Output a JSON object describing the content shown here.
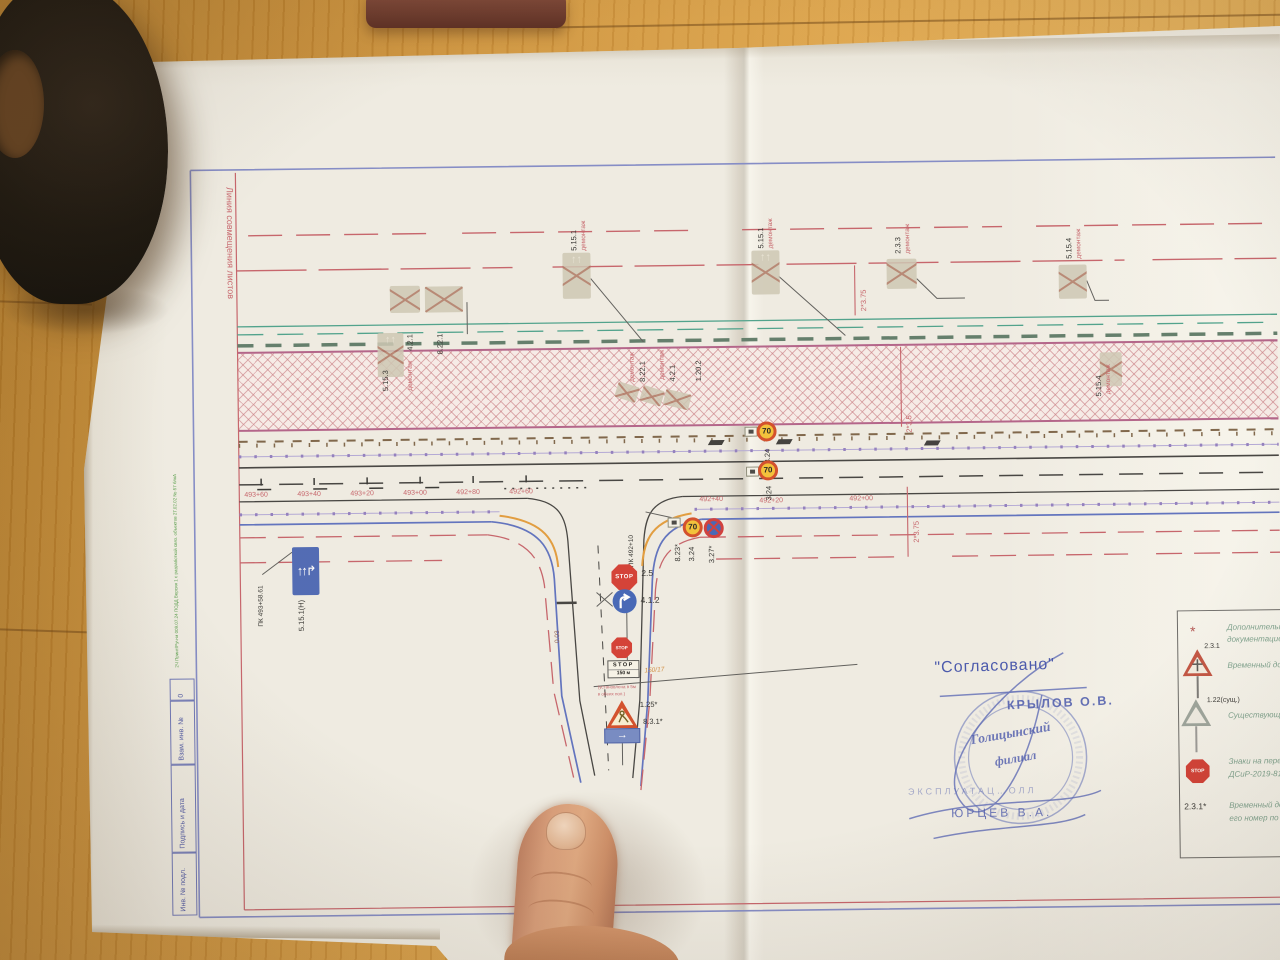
{
  "plan": {
    "edge_note": "Линия совмещения листов",
    "side_note": "2Ч Принт/Руч-м 009.07.24 ПОДД Версия 1 с разработкой связ. объектов 2Т.02.02 №-57 блкА",
    "titleblock": {
      "row_top": "Взам. инв. №",
      "row_mid": "Подпись и дата",
      "row_bot": "Инв. № подл.",
      "mark": "0"
    },
    "demo_note": "демонтаж",
    "demo_signs": [
      {
        "label": "4.2.1"
      },
      {
        "label": "8.22.1"
      },
      {
        "label": "5.15.1"
      },
      {
        "label": "5.15.1"
      },
      {
        "label": "2.3.3"
      },
      {
        "label": "5.15.4"
      },
      {
        "label": "5.15.3"
      },
      {
        "label": "8.22.1"
      },
      {
        "label": "4.2.1"
      },
      {
        "label": "1.20.2"
      },
      {
        "label": "5.15.4"
      }
    ],
    "dims": [
      "2*3.75",
      "2*3.5",
      "2*3.75"
    ],
    "chainage": [
      "493+60",
      "493+40",
      "493+20",
      "493+00",
      "492+80",
      "492+60",
      "492+40",
      "492+20",
      "492+00"
    ],
    "stations": {
      "left": "ПК 493+58.61",
      "junction": "ПК 492+10"
    },
    "speed": {
      "value": "70",
      "label": "3.24",
      "plate_label": "8.23*",
      "no_stop_label": "3.27*"
    },
    "lane_sign": {
      "label": "5.15.1(Н)",
      "arrows": "↑↑↱"
    },
    "radius_label": "0.03",
    "junction": {
      "stop_word": "STOP",
      "stop_label": "2.5",
      "turn_label": "4.1.2",
      "works_label": "1.25*",
      "dir_label": "8.3.1*",
      "dir_arrow": "→",
      "plate_line1": "STOP",
      "plate_line2": "150 м",
      "hand_note": "150/17",
      "install_note_1": "(установлена в 5м",
      "install_note_2": "в обеих пол.)"
    }
  },
  "stamp": {
    "approved": "\"Согласовано\"",
    "name1": "КРЫЛОВ О.В.",
    "seal_line1": "Голицынский",
    "seal_line2": "филиал",
    "dept": "ЭКСПЛУАТАЦ…ОЛЛ",
    "name2": "ЮРЦЕВ В.А."
  },
  "legend": {
    "star": "*",
    "stop_word": "STOP",
    "items": [
      {
        "label": "",
        "text1": "Дополнительны",
        "text2": "документацией"
      },
      {
        "label": "2.3.1",
        "text1": "Временный дор",
        "text2": ""
      },
      {
        "label": "1.22(сущ.)",
        "text1": "Существующий",
        "text2": ""
      },
      {
        "label": "",
        "text1": "Знаки на пере",
        "text2": "ДСиР-2019-81"
      },
      {
        "label": "2.3.1*",
        "text1": "Временный дор",
        "text2": "его номер по"
      }
    ]
  }
}
